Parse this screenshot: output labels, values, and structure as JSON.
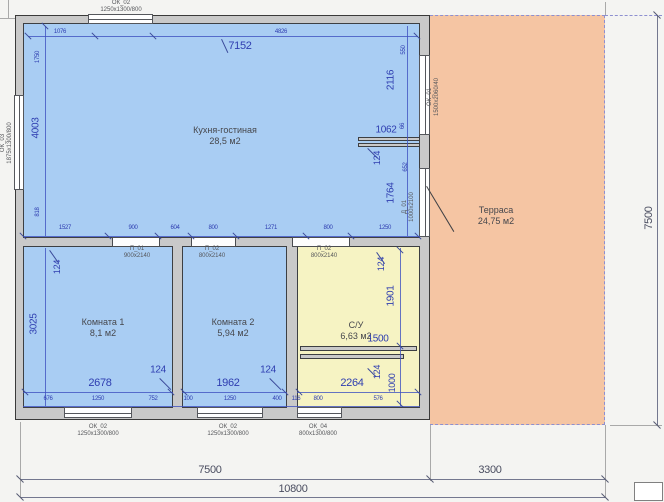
{
  "drawing": {
    "title": "floor-plan",
    "rooms": {
      "kitchen": {
        "name": "Кухня-гостиная",
        "area": "28,5 м2"
      },
      "terrace": {
        "name": "Терраса",
        "area": "24,75 м2"
      },
      "room1": {
        "name": "Комната 1",
        "area": "8,1 м2"
      },
      "room2": {
        "name": "Комната 2",
        "area": "5,94 м2"
      },
      "bathroom": {
        "name": "С/У",
        "area": "6,63 м2"
      }
    },
    "openings": {
      "ok02_top": {
        "code": "ОК_02",
        "size": "1250x1300/800"
      },
      "ok03_left": {
        "code": "ОК_03",
        "size": "1875x1300/800"
      },
      "ok01_terrace": {
        "code": "ОК_01",
        "size": "1500x2060/40"
      },
      "d01_terrace": {
        "code": "Д_01",
        "size": "1000x2100"
      },
      "p01": {
        "code": "П_01",
        "size": "900x2140"
      },
      "p02a": {
        "code": "П_02",
        "size": "800x2140"
      },
      "p02b": {
        "code": "П_02",
        "size": "800x2140"
      },
      "ok02_b1": {
        "code": "ОК_02",
        "size": "1250x1300/800"
      },
      "ok02_b2": {
        "code": "ОК_02",
        "size": "1250x1300/800"
      },
      "ok04_b3": {
        "code": "ОК_04",
        "size": "800x1300/800"
      }
    },
    "dims": {
      "overall": {
        "main_width": "7500",
        "terrace_width": "3300",
        "total_width": "10800",
        "height": "7500"
      },
      "kitchen": {
        "diag": "7152",
        "top_left": "1076",
        "top_right": "4826",
        "left": [
          "1750",
          "4003",
          "818"
        ],
        "bottom": [
          "1527",
          "900",
          "604",
          "800",
          "1271",
          "800",
          "1250"
        ],
        "right": [
          "550",
          "2116",
          "1062",
          "66",
          "124",
          "652",
          "1764"
        ]
      },
      "room1": {
        "wall": "124",
        "height": "3025",
        "width": "2678",
        "wall2": "124"
      },
      "room2": {
        "width": "1962",
        "wall": "124"
      },
      "bathroom": {
        "wall_top": "124",
        "height": "1901",
        "shelf": "1500",
        "wall_bottom": "124",
        "niche": "1000",
        "width": "2264"
      },
      "bottom_row": [
        "676",
        "1250",
        "752",
        "100",
        "1250",
        "400",
        "116",
        "800",
        "576"
      ]
    },
    "colors": {
      "room_fill": "#a9cdf3",
      "wet_fill": "#f6f3c3",
      "terrace_fill": "#f5c5a3",
      "wall_fill": "#c9c9c9",
      "dim_color": "#2e3db0"
    }
  }
}
